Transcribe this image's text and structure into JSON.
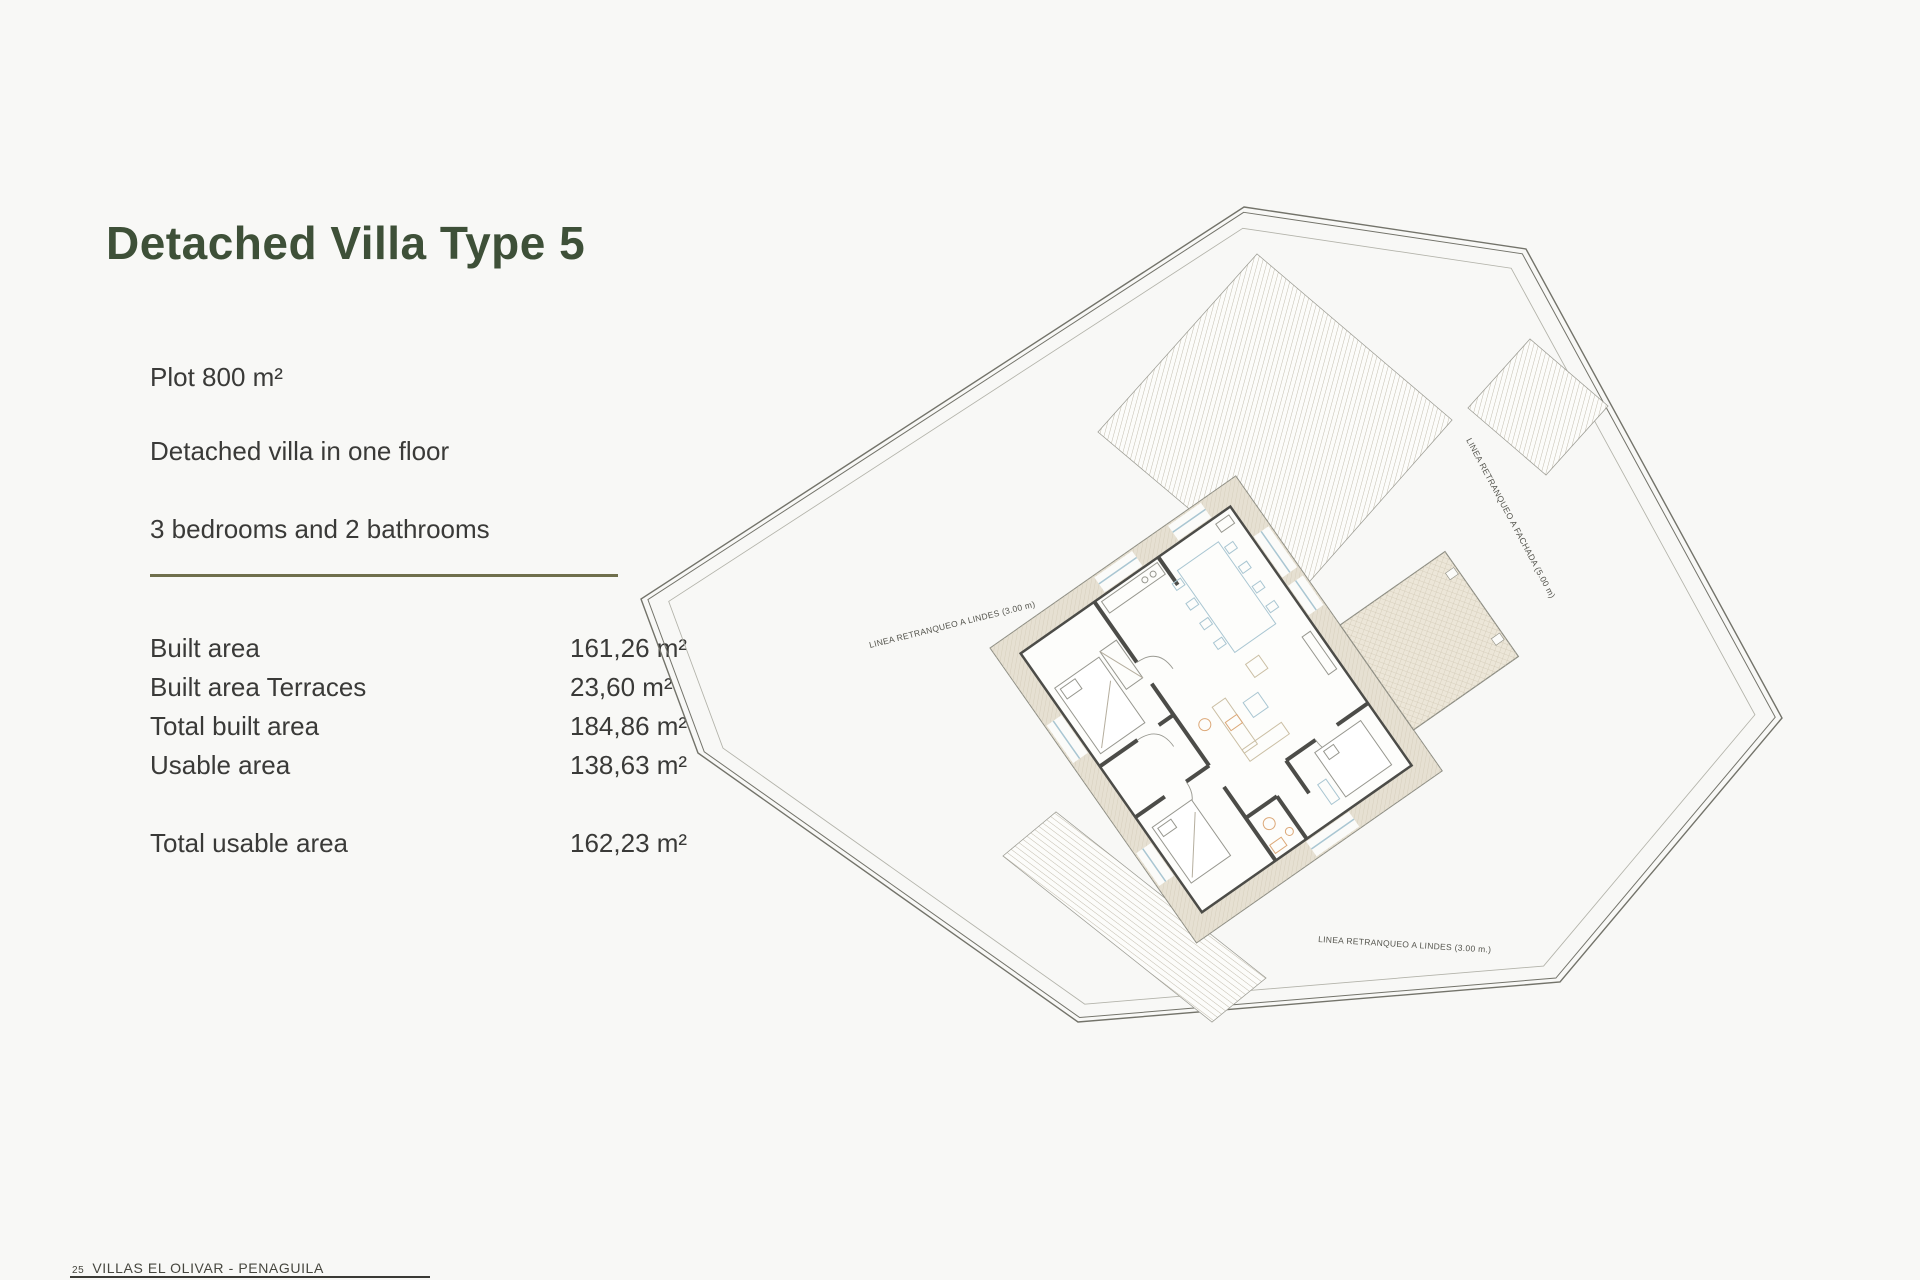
{
  "header": {
    "title": "Detached Villa Type 5"
  },
  "description": {
    "line1": "Plot 800 m²",
    "line2": "Detached villa in one floor",
    "line3": "3 bedrooms and 2 bathrooms"
  },
  "areas": {
    "rows": [
      {
        "label": "Built area",
        "value": "161,26 m²"
      },
      {
        "label": "Built area Terraces",
        "value": "23,60 m²"
      },
      {
        "label": "Total built area",
        "value": "184,86 m²"
      },
      {
        "label": "Usable area",
        "value": "138,63 m²"
      }
    ],
    "total": {
      "label": "Total usable area",
      "value": "162,23 m²"
    }
  },
  "footer": {
    "page_number": "25",
    "project": "VILLAS EL OLIVAR - PENAGUILA"
  },
  "plan": {
    "labels": {
      "setback_left": "LINEA RETRANQUEO A LINDES (3.00 m)",
      "setback_right": "LINEA RETRANQUEO A FACHADA (5.00 m)",
      "setback_bottom": "LINEA RETRANQUEO A LINDES (3.00 m.)"
    }
  },
  "colors": {
    "background": "#f8f8f6",
    "title_green": "#3e5038",
    "body_text": "#3a3a38",
    "divider_olive": "#6f6f4c",
    "footer_text": "#46463e",
    "plan_boundary": "#73736a",
    "plan_setback": "#b3b3aa",
    "plan_wall": "#4c4c48",
    "plan_band_fill": "#e6e0d2",
    "plan_stripe": "#bdb6a6",
    "plan_furniture_blue": "#a9c6d2",
    "plan_furniture_tan": "#cbbfa4",
    "plan_fixture_orange": "#dca878"
  }
}
